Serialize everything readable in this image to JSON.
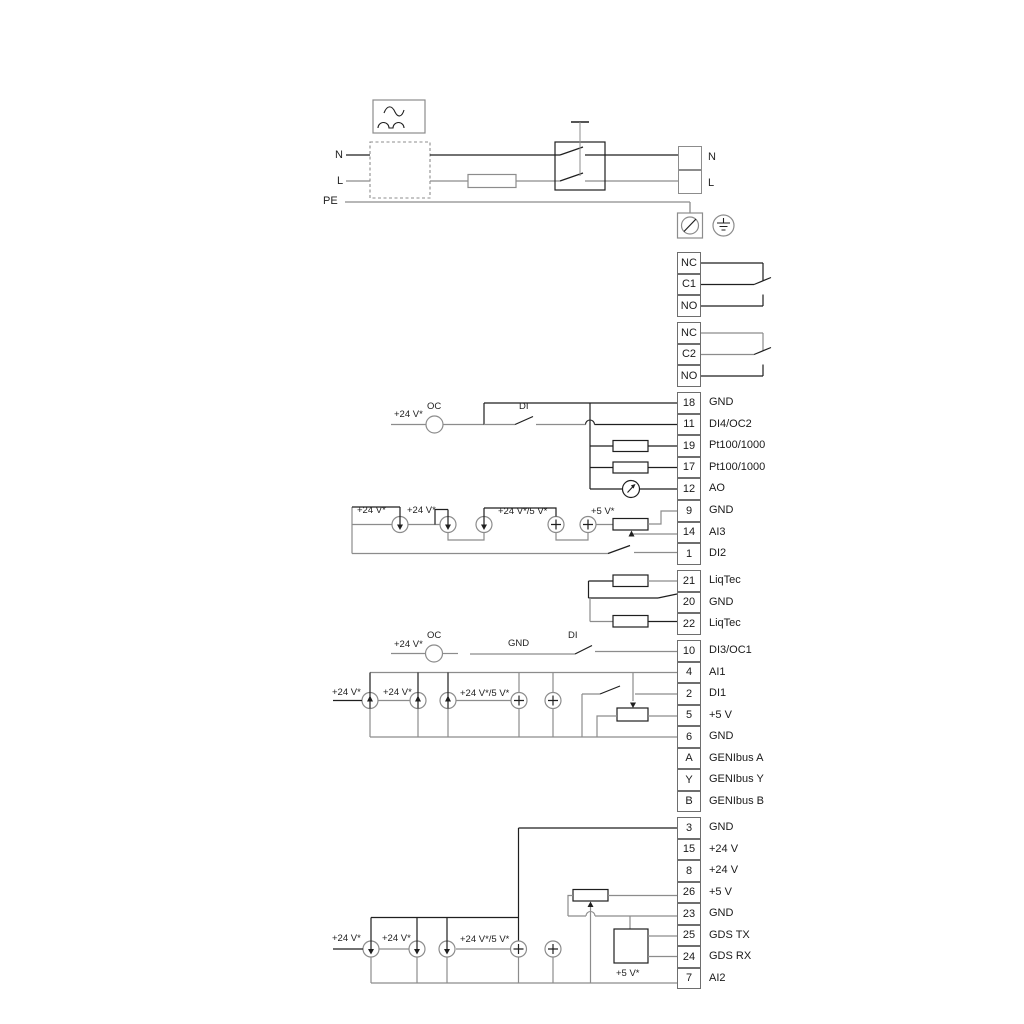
{
  "colors": {
    "wire_gray": "#8c8c8c",
    "wire_dark": "#1f1f1f"
  },
  "power": {
    "n_left": "N",
    "l_left": "L",
    "pe": "PE",
    "terminal_n": "N",
    "terminal_l": "L"
  },
  "relay1": {
    "t1": "NC",
    "t2": "C1",
    "t3": "NO"
  },
  "relay2": {
    "t1": "NC",
    "t2": "C2",
    "t3": "NO"
  },
  "strip1": [
    {
      "num": "18",
      "label": "GND"
    },
    {
      "num": "11",
      "label": "DI4/OC2"
    },
    {
      "num": "19",
      "label": "Pt100/1000"
    },
    {
      "num": "17",
      "label": "Pt100/1000"
    },
    {
      "num": "12",
      "label": "AO"
    }
  ],
  "strip2": [
    {
      "num": "9",
      "label": "GND"
    },
    {
      "num": "14",
      "label": "AI3"
    },
    {
      "num": "1",
      "label": "DI2"
    }
  ],
  "strip3": [
    {
      "num": "21",
      "label": "LiqTec"
    },
    {
      "num": "20",
      "label": "GND"
    },
    {
      "num": "22",
      "label": "LiqTec"
    }
  ],
  "strip4": [
    {
      "num": "10",
      "label": "DI3/OC1"
    },
    {
      "num": "4",
      "label": "AI1"
    },
    {
      "num": "2",
      "label": "DI1"
    },
    {
      "num": "5",
      "label": "+5 V"
    },
    {
      "num": "6",
      "label": "GND"
    },
    {
      "num": "A",
      "label": "GENIbus A"
    },
    {
      "num": "Y",
      "label": "GENIbus Y"
    },
    {
      "num": "B",
      "label": "GENIbus B"
    }
  ],
  "strip5": [
    {
      "num": "3",
      "label": "GND"
    },
    {
      "num": "15",
      "label": "+24 V"
    },
    {
      "num": "8",
      "label": "+24 V"
    },
    {
      "num": "26",
      "label": "+5 V"
    },
    {
      "num": "23",
      "label": "GND"
    },
    {
      "num": "25",
      "label": "GDS TX"
    },
    {
      "num": "24",
      "label": "GDS RX"
    },
    {
      "num": "7",
      "label": "AI2"
    }
  ],
  "di4_row": {
    "v24": "+24 V*",
    "oc": "OC",
    "di": "DI"
  },
  "analog_row1": {
    "v24_a": "+24 V*",
    "v24_b": "+24 V*",
    "v24_5v": "+24 V*/5 V*",
    "v5": "+5 V*"
  },
  "di3_row": {
    "v24": "+24 V*",
    "oc": "OC",
    "gnd": "GND",
    "di": "DI"
  },
  "analog_row2": {
    "v24_a": "+24 V*",
    "v24_b": "+24 V*",
    "v24_5v": "+24 V*/5 V*"
  },
  "analog_row3": {
    "v24_a": "+24 V*",
    "v24_b": "+24 V*",
    "v24_5v": "+24 V*/5 V*",
    "v5": "+5 V*"
  }
}
